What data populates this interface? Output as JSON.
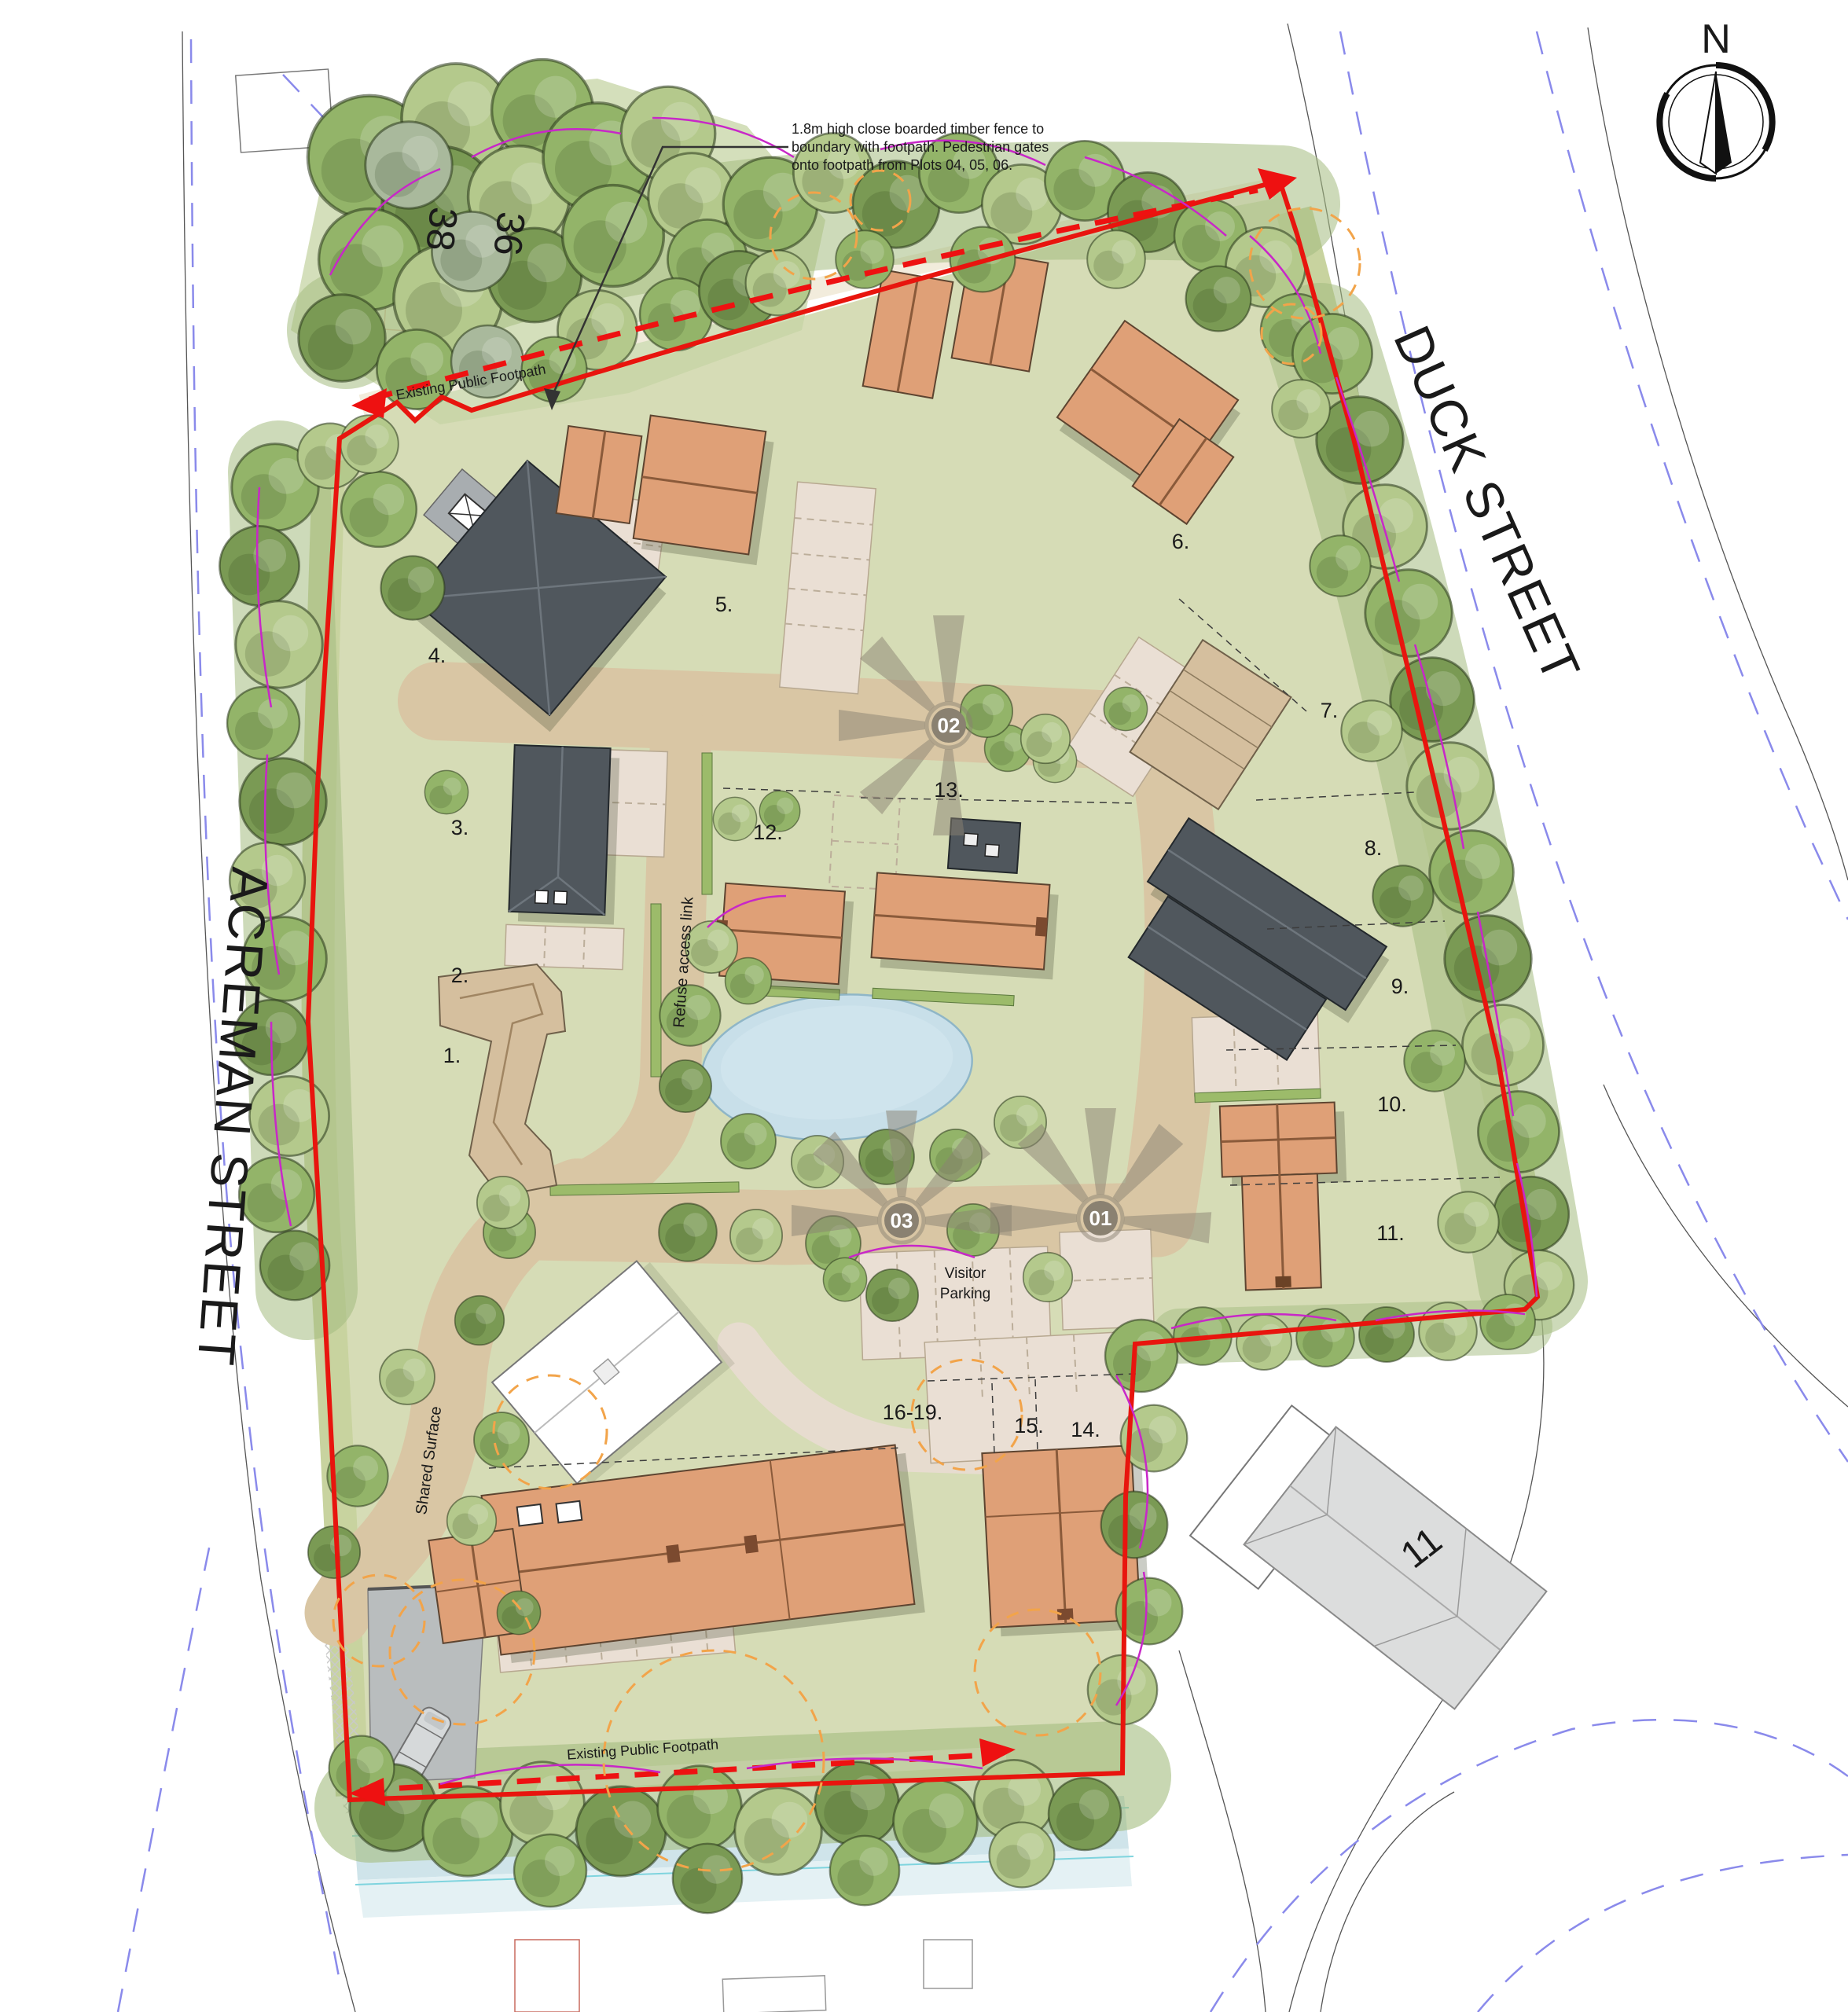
{
  "compass": {
    "label": "N"
  },
  "annotation": {
    "line1": "1.8m high close boarded timber fence to",
    "line2": "boundary with footpath. Pedestrian gates",
    "line3": "onto footpath from Plots 04, 05, 06."
  },
  "streets": {
    "acreman": "ACREMAN STREET",
    "duck": "DUCK STREET"
  },
  "footpath_labels": {
    "top": "Existing Public Footpath",
    "bottom": "Existing Public Footpath"
  },
  "site_labels": {
    "refuse_access": "Refuse access link",
    "visitor_line1": "Visitor",
    "visitor_line2": "Parking",
    "shared_surface": "Shared Surface"
  },
  "existing_buildings": {
    "no_38": "38",
    "no_36": "36",
    "no_11": "11"
  },
  "plot_labels": [
    {
      "label": "1."
    },
    {
      "label": "2."
    },
    {
      "label": "3."
    },
    {
      "label": "4."
    },
    {
      "label": "5."
    },
    {
      "label": "6."
    },
    {
      "label": "7."
    },
    {
      "label": "8."
    },
    {
      "label": "9."
    },
    {
      "label": "10."
    },
    {
      "label": "11."
    },
    {
      "label": "12."
    },
    {
      "label": "13."
    },
    {
      "label": "14."
    },
    {
      "label": "15."
    },
    {
      "label": "16-19."
    }
  ],
  "markers": {
    "m01": "01",
    "m02": "02",
    "m03": "03"
  },
  "colors": {
    "site_green": "#d6dcb6",
    "road_tan": "#d9c6a4",
    "court_pink": "#eadfd4",
    "path_cream": "#f2ecdc",
    "pond_blue": "#c8dfe9",
    "building_orange": "#dfa077",
    "building_dark": "#50575d",
    "building_tan": "#d5bf9e",
    "existing_gray": "#dcdddd",
    "boundary_red": "#e8150e",
    "magenta_arc": "#c827c8",
    "orange_dash": "#f2a44a",
    "blue_dash": "#8a8aeb",
    "marker_gray": "#8a8171",
    "tree_light": "#b4c98c",
    "tree_mid": "#93b469",
    "tree_dark": "#7a9a54",
    "number_darkred": "#7a2f20"
  }
}
